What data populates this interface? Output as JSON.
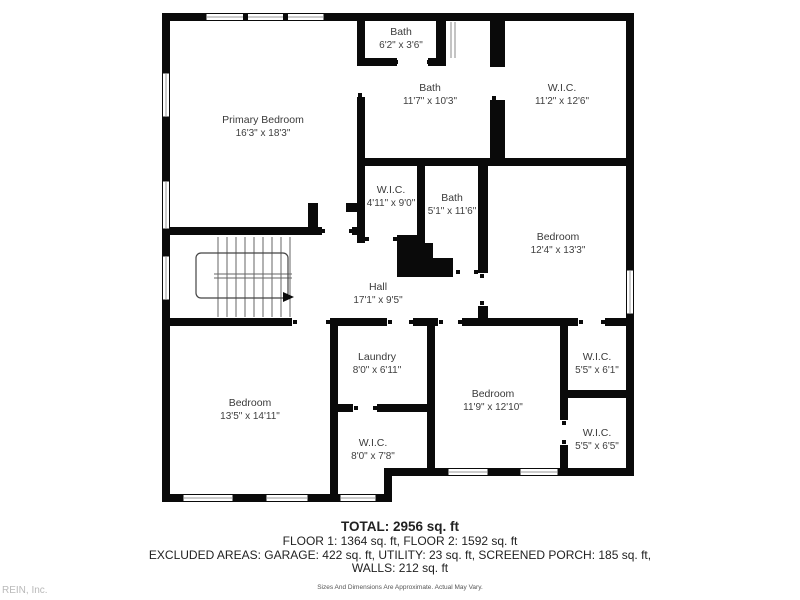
{
  "watermark": "REIN, Inc.",
  "rooms": [
    {
      "name": "Primary Bedroom",
      "dims": "16'3\" x 18'3\""
    },
    {
      "name": "Bath",
      "dims": "6'2\" x 3'6\""
    },
    {
      "name": "Bath",
      "dims": "11'7\" x 10'3\""
    },
    {
      "name": "W.I.C.",
      "dims": "11'2\" x 12'6\""
    },
    {
      "name": "W.I.C.",
      "dims": "4'11\" x 9'0\""
    },
    {
      "name": "Bath",
      "dims": "5'1\" x 11'6\""
    },
    {
      "name": "Bedroom",
      "dims": "12'4\" x 13'3\""
    },
    {
      "name": "Hall",
      "dims": "17'1\" x 9'5\""
    },
    {
      "name": "Bedroom",
      "dims": "13'5\" x 14'11\""
    },
    {
      "name": "Laundry",
      "dims": "8'0\" x 6'11\""
    },
    {
      "name": "W.I.C.",
      "dims": "8'0\" x 7'8\""
    },
    {
      "name": "Bedroom",
      "dims": "11'9\" x 12'10\""
    },
    {
      "name": "W.I.C.",
      "dims": "5'5\" x 6'1\""
    },
    {
      "name": "W.I.C.",
      "dims": "5'5\" x 6'5\""
    }
  ],
  "summary": {
    "total": "TOTAL: 2956 sq. ft",
    "floors": "FLOOR 1: 1364 sq. ft, FLOOR 2: 1592 sq. ft",
    "excluded": "EXCLUDED AREAS: GARAGE: 422 sq. ft, UTILITY: 23 sq. ft, SCREENED PORCH: 185 sq. ft,",
    "walls": "WALLS: 212 sq. ft",
    "disclaimer": "Sizes And Dimensions Are Approximate. Actual May Vary."
  },
  "colors": {
    "wall": "#0a0a0a",
    "label_text": "#3a3a3a",
    "watermark": "#b9b9b9",
    "window_line": "#999999",
    "stair_line": "#666666"
  }
}
